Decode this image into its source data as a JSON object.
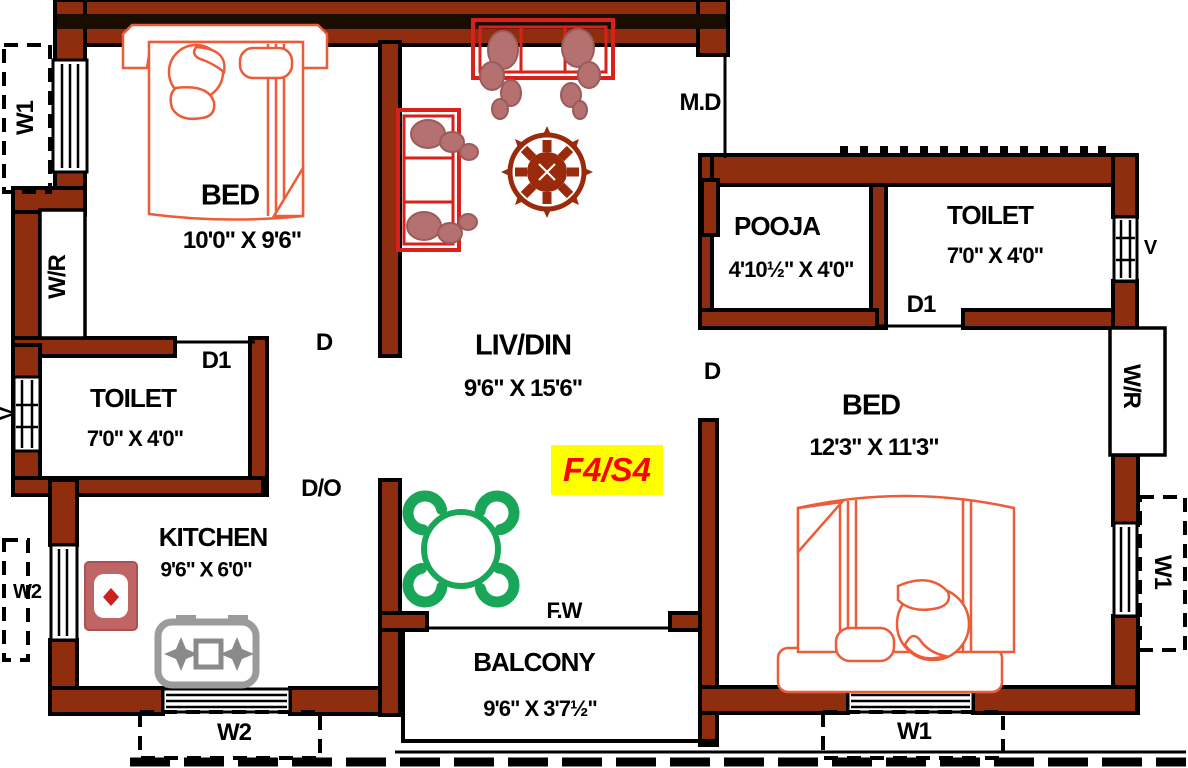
{
  "unit_badge": "F4/S4",
  "rooms": {
    "bed1": {
      "name": "BED",
      "dims": "10'0\" X 9'6\""
    },
    "livdin": {
      "name": "LIV/DIN",
      "dims": "9'6\" X 15'6\""
    },
    "pooja": {
      "name": "POOJA",
      "dims": "4'10½\" X 4'0\""
    },
    "toilet_top": {
      "name": "TOILET",
      "dims": "7'0\" X 4'0\""
    },
    "bed2": {
      "name": "BED",
      "dims": "12'3\" X 11'3\""
    },
    "toilet_left": {
      "name": "TOILET",
      "dims": "7'0\" X 4'0\""
    },
    "kitchen": {
      "name": "KITCHEN",
      "dims": "9'6\" X 6'0\""
    },
    "balcony": {
      "name": "BALCONY",
      "dims": "9'6\" X 3'7½\""
    }
  },
  "markers": {
    "main_door": "M.D",
    "door": "D",
    "door1": "D1",
    "door_opening": "D/O",
    "french_window": "F.W",
    "ventilator": "V",
    "wardrobe": "W/R",
    "window1": "W1",
    "window2": "W2"
  },
  "colors": {
    "wall": "#8e2e0f",
    "outline": "#000000",
    "bed_furniture": "#ed5c38",
    "sofa": "#d9201a",
    "plant": "#b57070",
    "fan": "#992a0c",
    "dining_table": "#19a658",
    "sink": "#c06565",
    "sink_diamond": "#cc1f1f",
    "stove": "#9b9b9b",
    "badge_bg": "#ffff00",
    "badge_text": "#ff0000"
  }
}
